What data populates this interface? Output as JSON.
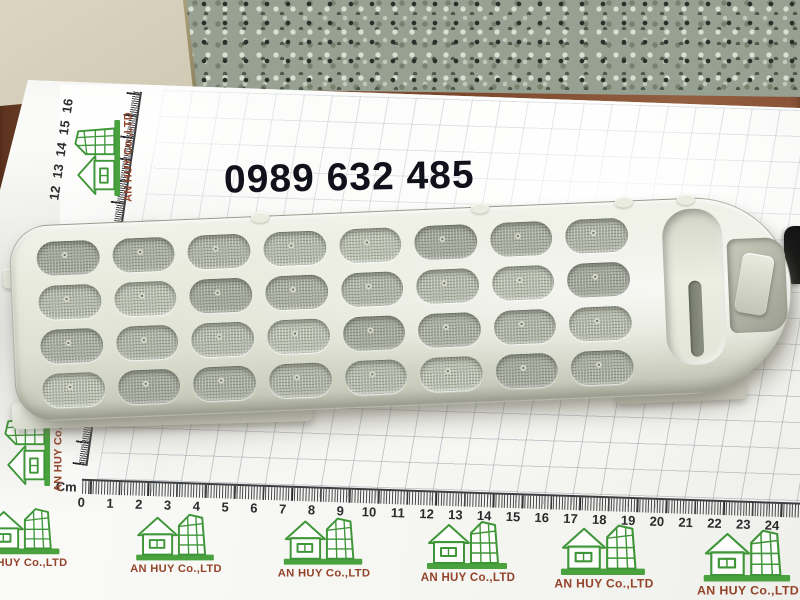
{
  "watermark": {
    "phone_number": "0989 632 485"
  },
  "brand": {
    "name": "AN HUY Co.,LTD",
    "logo_icon": "house-and-building-icon"
  },
  "ruler": {
    "unit_label": "Cm",
    "horizontal_numbers": [
      "0",
      "1",
      "2",
      "3",
      "4",
      "5",
      "6",
      "7",
      "8",
      "9",
      "10",
      "11",
      "12",
      "13",
      "14",
      "15",
      "16",
      "17",
      "18",
      "19",
      "20",
      "21",
      "22",
      "23",
      "24"
    ],
    "vertical_numbers_low": [
      "1",
      "2"
    ],
    "vertical_numbers_high": [
      "12",
      "13",
      "14",
      "15",
      "16"
    ]
  },
  "product": {
    "mesh_rows": 4,
    "mesh_columns": 8
  },
  "colors": {
    "logo_green": "#3f9638",
    "logo_bar_green": "#4aa23e",
    "logo_text_brown": "#93442a",
    "ruler_ink": "#2a2c2e",
    "phone_ink": "#10111a",
    "paper_white": "#f6f6f2",
    "filter_plastic": "#e7e9dc",
    "mesh_gray": "#adb2a4",
    "granite_gray_green": "#97a192",
    "wood_brown": "#7c492e",
    "wall_beige": "#d6cfbc",
    "black_object": "#161616"
  }
}
